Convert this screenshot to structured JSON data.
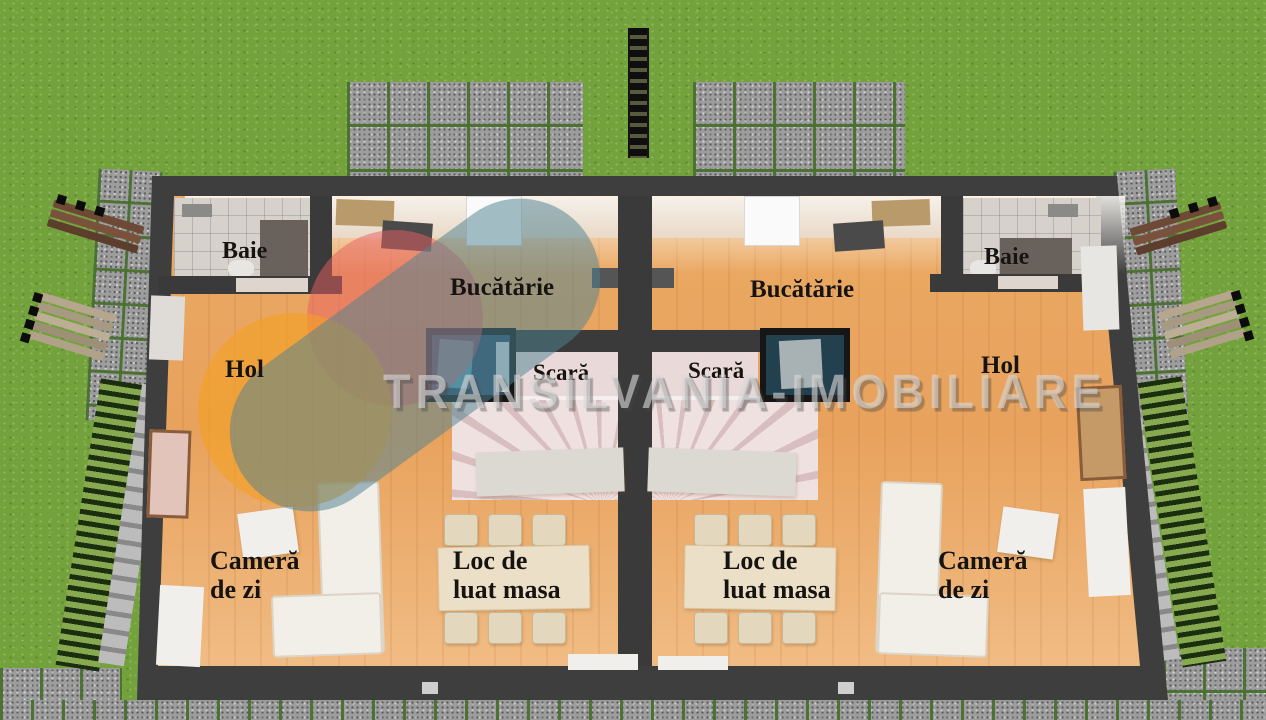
{
  "watermark": {
    "brand": "TRANSILVANIA-IMOBILIARE"
  },
  "units": {
    "left": {
      "bathroom": "Baie",
      "kitchen": "Bucătărie",
      "hall": "Hol",
      "stairs": "Scară",
      "living": "Cameră\nde zi",
      "dining": "Loc de\nluat masa"
    },
    "right": {
      "bathroom": "Baie",
      "kitchen": "Bucătărie",
      "hall": "Hol",
      "stairs": "Scară",
      "living": "Cameră\nde zi",
      "dining": "Loc de\nluat masa"
    }
  },
  "colors": {
    "grass": "#73a23c",
    "paver": "#9d9d9d",
    "wall": "#3e3e3e",
    "wood_floor": "#e8a25d",
    "label_text": "#161310",
    "logo_pink": "#e75d62",
    "logo_orange": "#f39f24",
    "logo_teal": "#50828f",
    "watermark_text": "#d6d6d6"
  }
}
